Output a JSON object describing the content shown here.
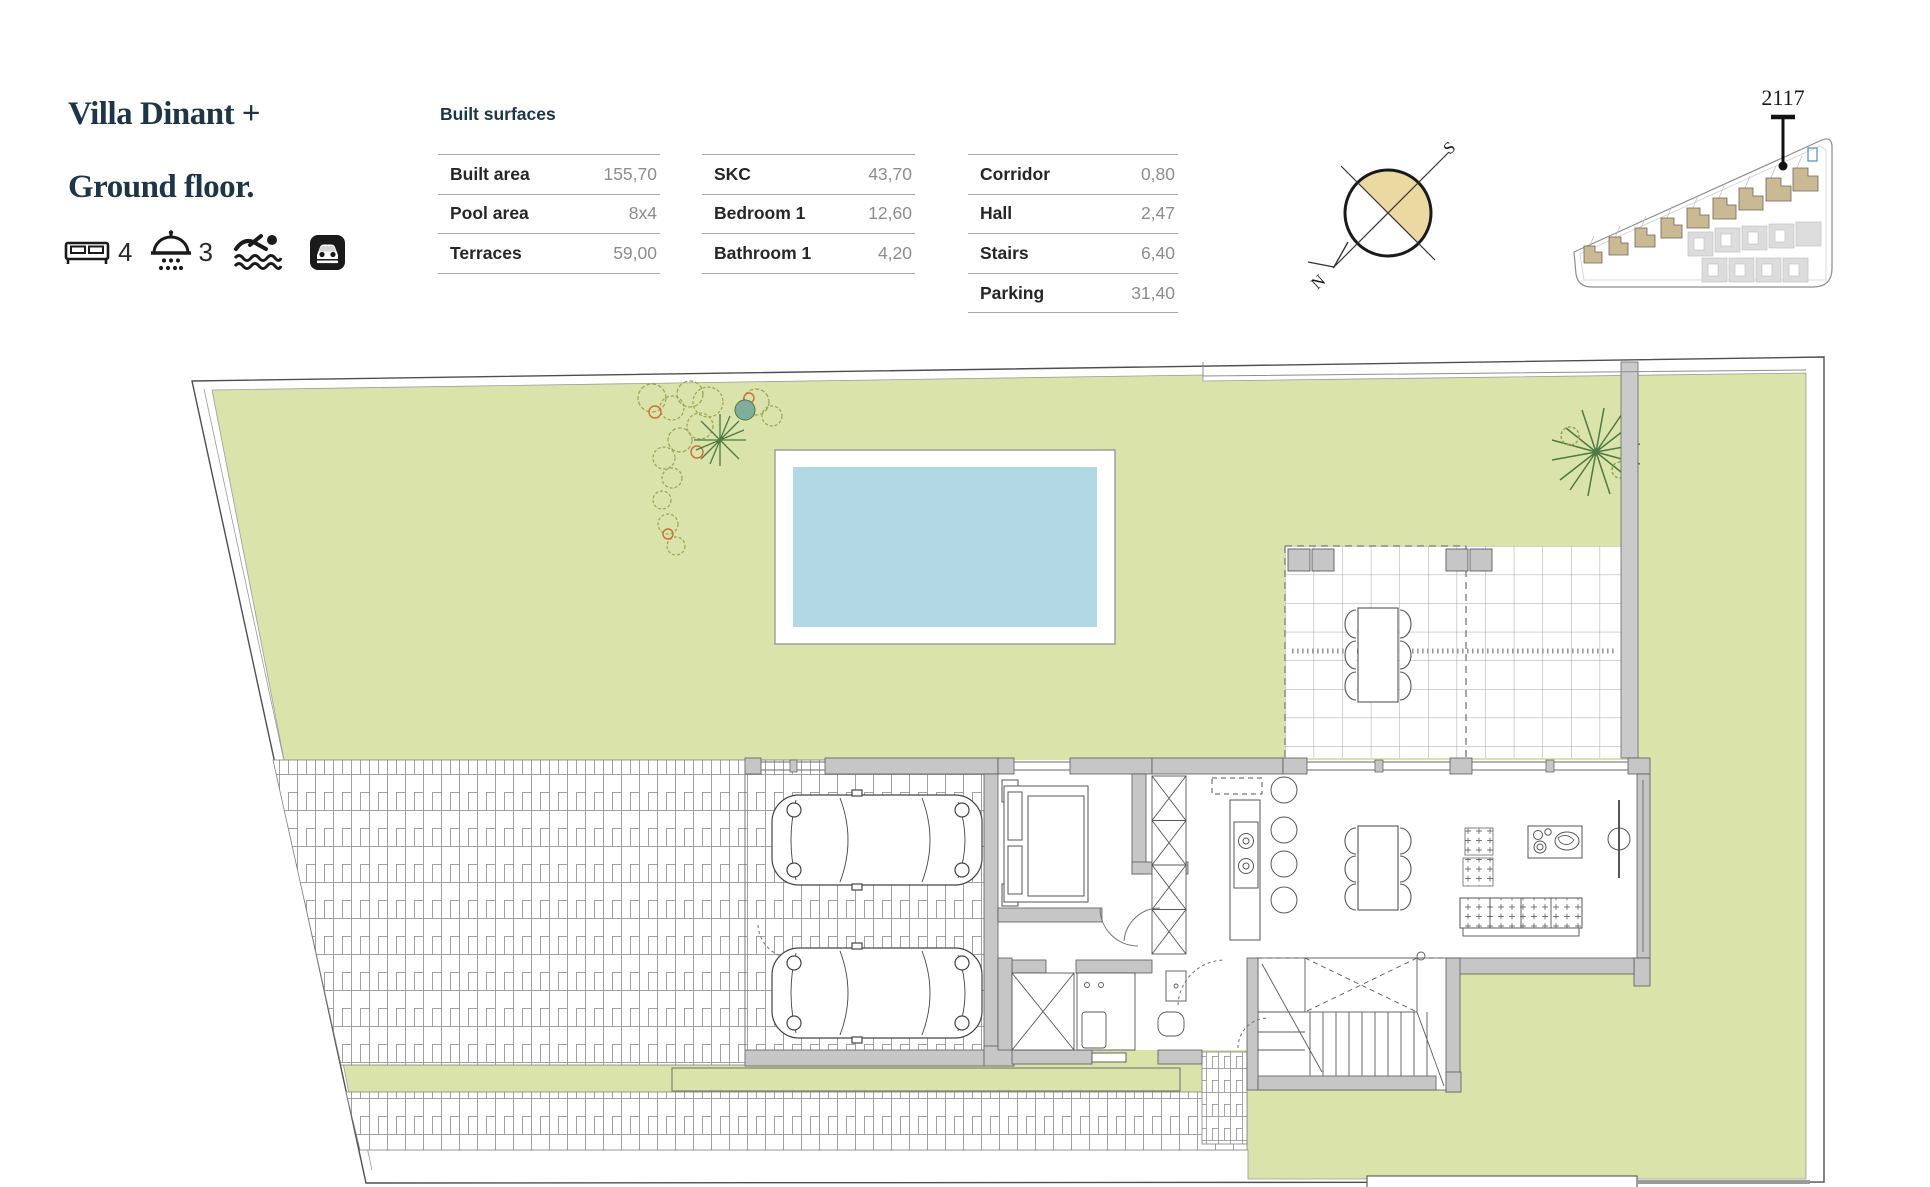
{
  "header": {
    "title_line1": "Villa Dinant +",
    "title_line2": "Ground floor.",
    "icons": [
      {
        "name": "bed-icon",
        "count": "4"
      },
      {
        "name": "shower-icon",
        "count": "3"
      },
      {
        "name": "swimmer-icon"
      },
      {
        "name": "parking-icon"
      }
    ]
  },
  "surfaces": {
    "heading": "Built surfaces",
    "t1": [
      {
        "label": "Built area",
        "value": "155,70"
      },
      {
        "label": "Pool area",
        "value": "8x4"
      },
      {
        "label": "Terraces",
        "value": "59,00"
      }
    ],
    "t2": [
      {
        "label": "SKC",
        "value": "43,70"
      },
      {
        "label": "Bedroom 1",
        "value": "12,60"
      },
      {
        "label": "Bathroom 1",
        "value": "4,20"
      }
    ],
    "t3": [
      {
        "label": "Corridor",
        "value": "0,80"
      },
      {
        "label": "Hall",
        "value": "2,47"
      },
      {
        "label": "Stairs",
        "value": "6,40"
      },
      {
        "label": "Parking",
        "value": "31,40"
      }
    ]
  },
  "compass": {
    "north": "N",
    "south": "S"
  },
  "site_plan": {
    "unit_label": "2117"
  },
  "colors": {
    "accent_navy": "#1d3547",
    "garden_green": "#d9e3aa",
    "pool_blue": "#b2d8e4",
    "wall_gray": "#c6c6c6",
    "compass_beige": "#ecd9a2",
    "villa_tan": "#c9ba94"
  }
}
